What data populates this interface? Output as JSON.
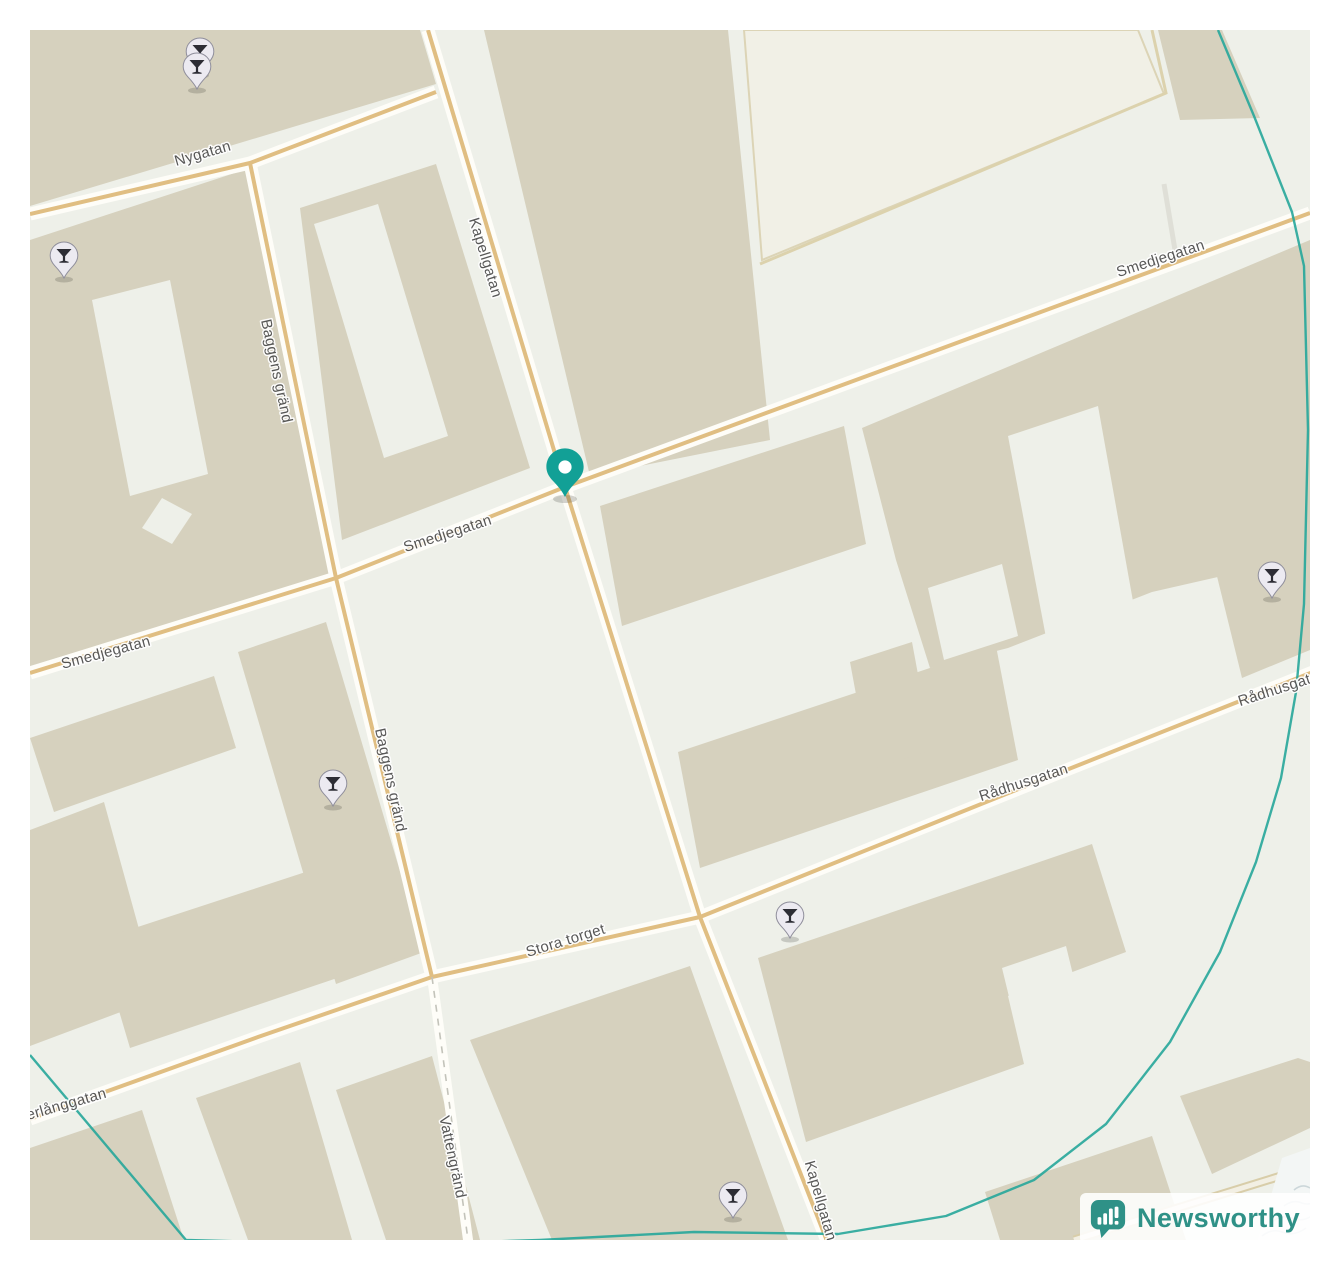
{
  "colors": {
    "background": "#ffffff",
    "map_bg": "#eef0e9",
    "building": "#d6d1be",
    "building_light": "#f1f0e6",
    "road_fill": "#fefdf8",
    "road_casing": "#e0be82",
    "boundary": "#26a69a",
    "label": "#4d4d4d",
    "marker": "#12a096",
    "pin_fill": "#eceaf1",
    "pin_stroke": "#8f8e9b",
    "pin_glyph": "#2d2d35",
    "logo_teal": "#2f9187",
    "water_line": "#ccd7da"
  },
  "map": {
    "street_labels": [
      {
        "text": "Nygatan",
        "x": 204,
        "y": 158,
        "rot": -16
      },
      {
        "text": "Kapellgatan",
        "x": 481,
        "y": 259,
        "rot": 73
      },
      {
        "text": "Smedjegatan",
        "x": 1162,
        "y": 263,
        "rot": -18
      },
      {
        "text": "Smedjegatan",
        "x": 449,
        "y": 538,
        "rot": -18
      },
      {
        "text": "Smedjegatan",
        "x": 107,
        "y": 657,
        "rot": -15
      },
      {
        "text": "Baggens gränd",
        "x": 272,
        "y": 372,
        "rot": 78
      },
      {
        "text": "Baggens gränd",
        "x": 386,
        "y": 781,
        "rot": 78
      },
      {
        "text": "Stora torget",
        "x": 567,
        "y": 945,
        "rot": -17
      },
      {
        "text": "Rådhusgatan",
        "x": 1025,
        "y": 787,
        "rot": -18
      },
      {
        "text": "Rådhusgatan",
        "x": 1284,
        "y": 692,
        "rot": -18
      },
      {
        "text": "Österlånggatan",
        "x": 56,
        "y": 1112,
        "rot": -16
      },
      {
        "text": "Vattengränd",
        "x": 448,
        "y": 1158,
        "rot": 78
      },
      {
        "text": "Kapellgatan",
        "x": 816,
        "y": 1202,
        "rot": 74
      }
    ],
    "pins": [
      {
        "type": "cocktail",
        "x": 200,
        "y": 74
      },
      {
        "type": "cocktail",
        "x": 197,
        "y": 89
      },
      {
        "type": "cocktail",
        "x": 64,
        "y": 278
      },
      {
        "type": "cocktail",
        "x": 1272,
        "y": 598
      },
      {
        "type": "cocktail",
        "x": 333,
        "y": 806
      },
      {
        "type": "cocktail",
        "x": 790,
        "y": 938
      },
      {
        "type": "cocktail",
        "x": 733,
        "y": 1218
      }
    ],
    "marker": {
      "x": 565,
      "y": 497
    }
  },
  "logo": {
    "text": "Newsworthy"
  }
}
